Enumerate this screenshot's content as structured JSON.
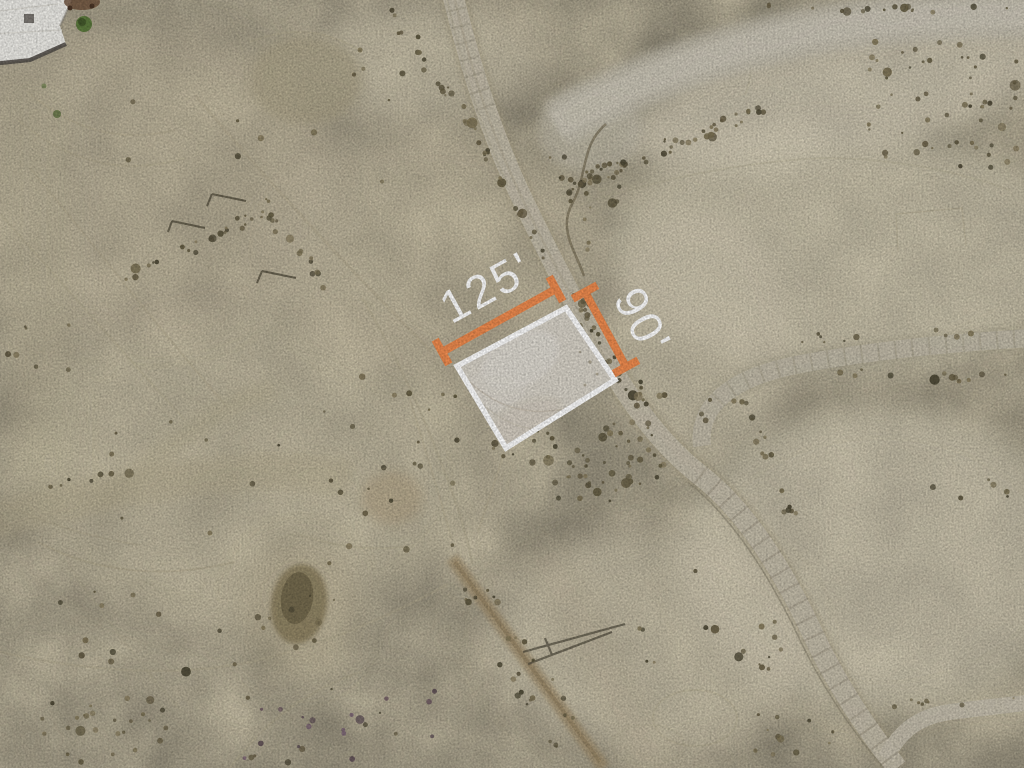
{
  "map_image": {
    "description": "Aerial satellite photo of a vacant desert land parcel outlined in white with orange dimension lines",
    "annotations": {
      "width_label": "125'",
      "height_label": "90'"
    },
    "parcel": {
      "width_feet": 125,
      "depth_feet": 90,
      "outline_color": "#ffffff"
    },
    "colors": {
      "dimension_accent": "#ee8b4f",
      "label_text": "#ffffff",
      "sand_base": "#cec5ab"
    }
  }
}
